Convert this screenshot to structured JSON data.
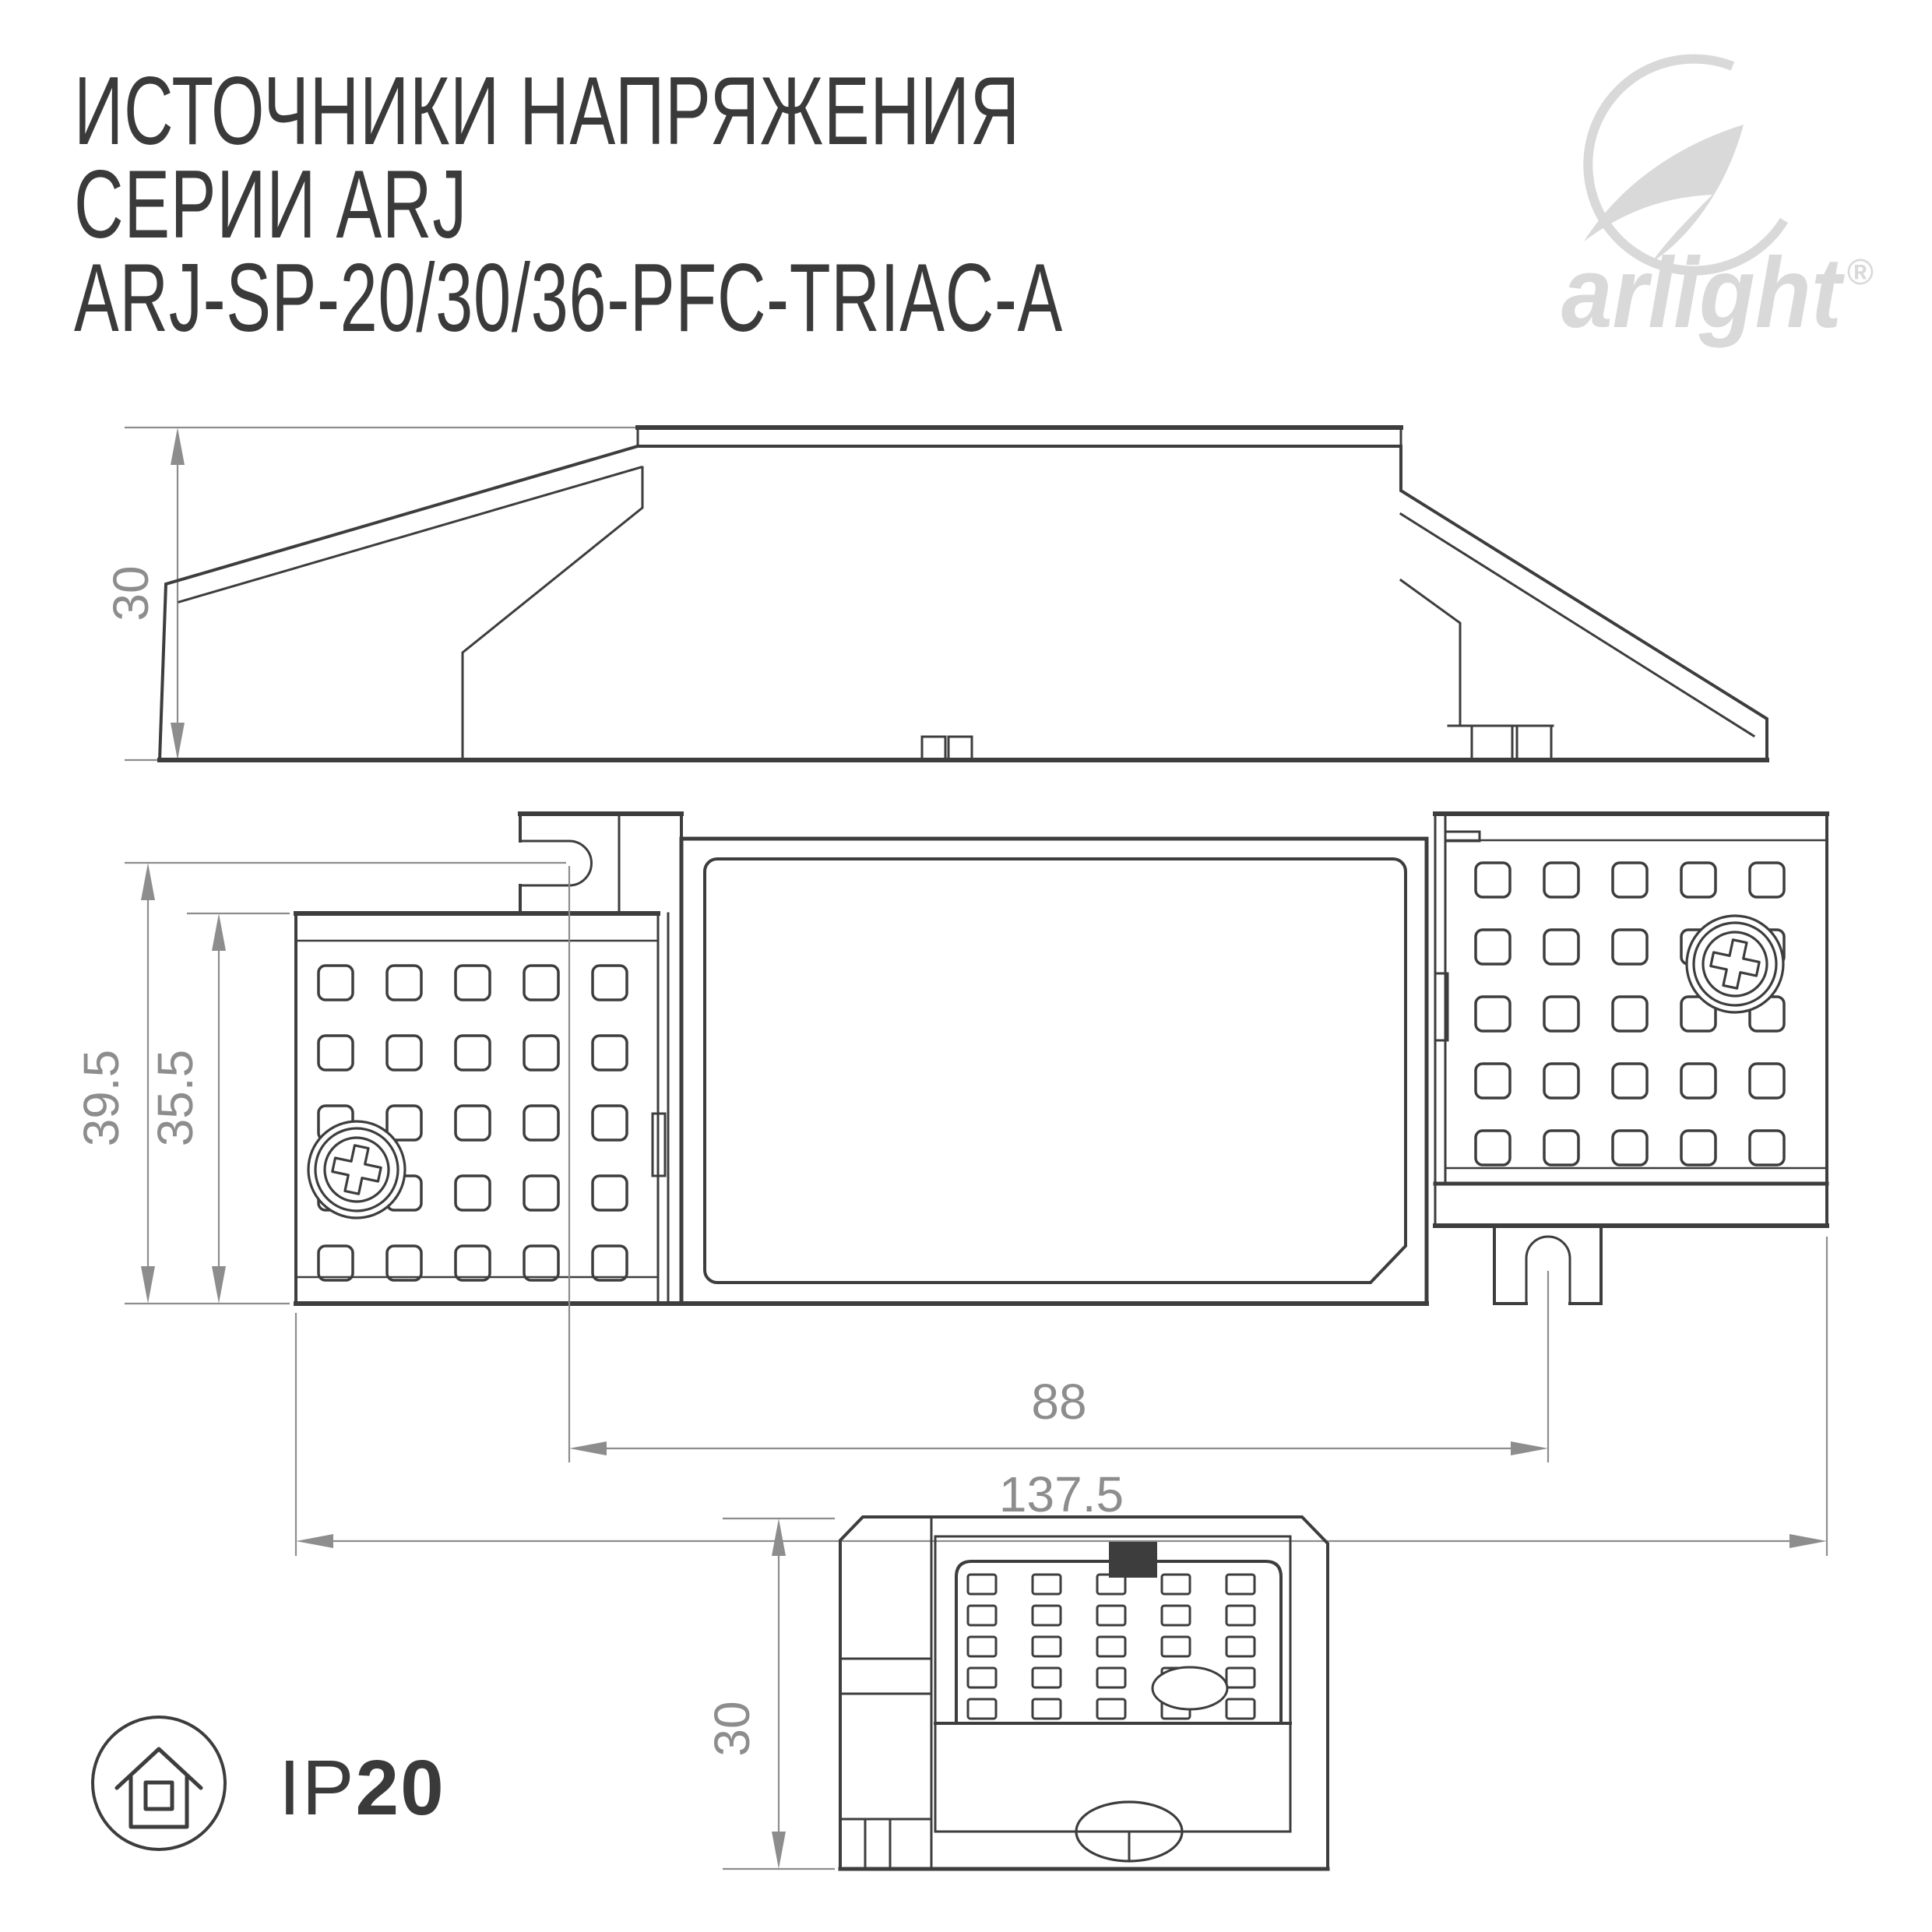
{
  "title_block": {
    "line1": "ИСТОЧНИКИ НАПРЯЖЕНИЯ",
    "line2": "СЕРИИ ARJ",
    "line3": "ARJ-SP-20/30/36-PFC-TRIAC-A"
  },
  "logo": {
    "brand": "arlight",
    "registered_mark": "®"
  },
  "views": {
    "side": {
      "height_mm": "30"
    },
    "plan": {
      "overall_length_mm": "137.5",
      "mount_slot_spacing_mm": "88",
      "overall_depth_mm": "39.5",
      "case_depth_mm": "35.5"
    },
    "end": {
      "height_mm": "30"
    }
  },
  "protection_badge": {
    "prefix": "IP",
    "rating": "20"
  },
  "colors": {
    "drawing_line": "#3d3d3d",
    "dimension": "#8d8d8d",
    "logo": "#d9d9d9",
    "background": "#ffffff"
  }
}
